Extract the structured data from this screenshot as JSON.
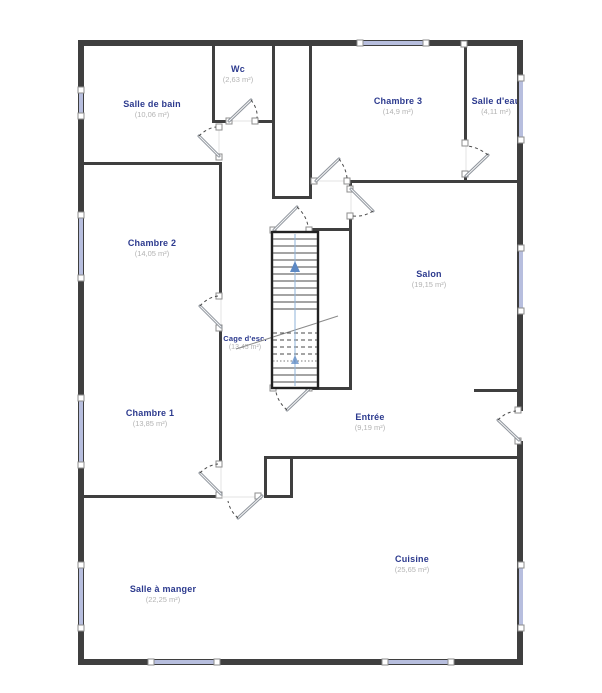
{
  "title": "Plan d'étage",
  "rooms": [
    {
      "name": "Salle de bain",
      "area": "(10,06 m²)"
    },
    {
      "name": "Wc",
      "area": "(2,63 m²)"
    },
    {
      "name": "Chambre 3",
      "area": "(14,9 m²)"
    },
    {
      "name": "Salle d'eau",
      "area": "(4,11 m²)"
    },
    {
      "name": "Chambre 2",
      "area": "(14,05 m²)"
    },
    {
      "name": "Salon",
      "area": "(19,15 m²)"
    },
    {
      "name": "Cage d'esc.",
      "area": "(13,45 m²)"
    },
    {
      "name": "Chambre 1",
      "area": "(13,85 m²)"
    },
    {
      "name": "Entrée",
      "area": "(9,19 m²)"
    },
    {
      "name": "Cuisine",
      "area": "(25,65 m²)"
    },
    {
      "name": "Salle à manger",
      "area": "(22,25 m²)"
    }
  ],
  "colors": {
    "wall": "#3f3f3f",
    "window": "#b7bede",
    "room_name": "#2c3a8e",
    "room_area": "#b3b3b3",
    "stair_guide": "#8fb3d9",
    "stair_arrow": "#5d89c4",
    "door_leaf": "#8f959d"
  }
}
